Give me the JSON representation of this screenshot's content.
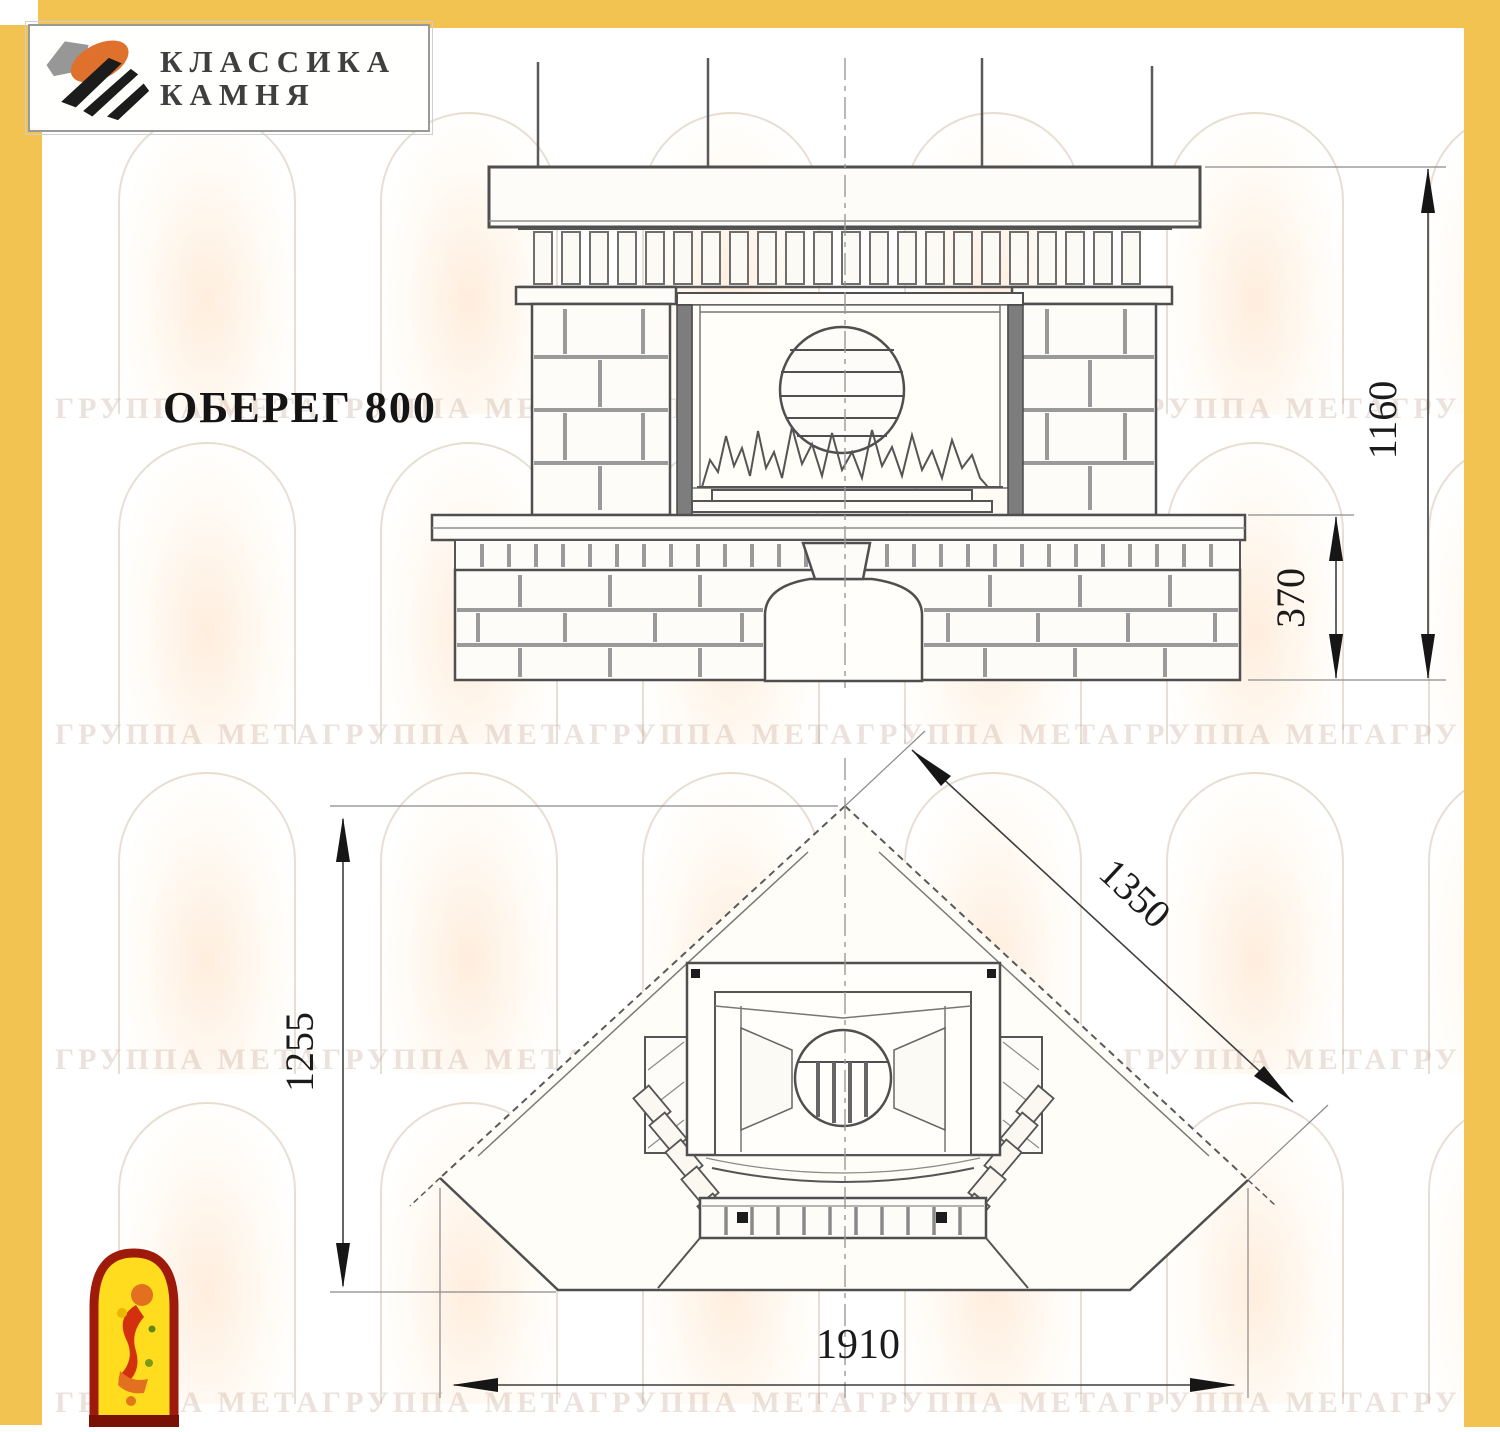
{
  "brand": {
    "logo_line1": "КЛАССИКА",
    "logo_line2": "КАМНЯ"
  },
  "drawing": {
    "title": "ОБЕРЕГ 800",
    "front_view": {
      "dim_total_height_mm": "1160",
      "dim_bench_height_mm": "370"
    },
    "plan_view": {
      "dim_depth_mm": "1255",
      "dim_diagonal_mm": "1350",
      "dim_width_mm": "1910"
    }
  },
  "watermark": {
    "repeat_unit": "ГРУППА МЕТА"
  },
  "icons": {
    "logo_icon": "stone-logo-icon",
    "footer_icon": "jester-arch-icon",
    "background_icon": "arch-figure-watermark"
  },
  "colors": {
    "frame": "#F3C351",
    "outline": "#4f4f4f",
    "mortar_joint": "#9b9b9b",
    "logo_orange": "#E0712C",
    "jester_border_red": "#9E1B0C",
    "jester_yellow": "#FFDD1E"
  }
}
